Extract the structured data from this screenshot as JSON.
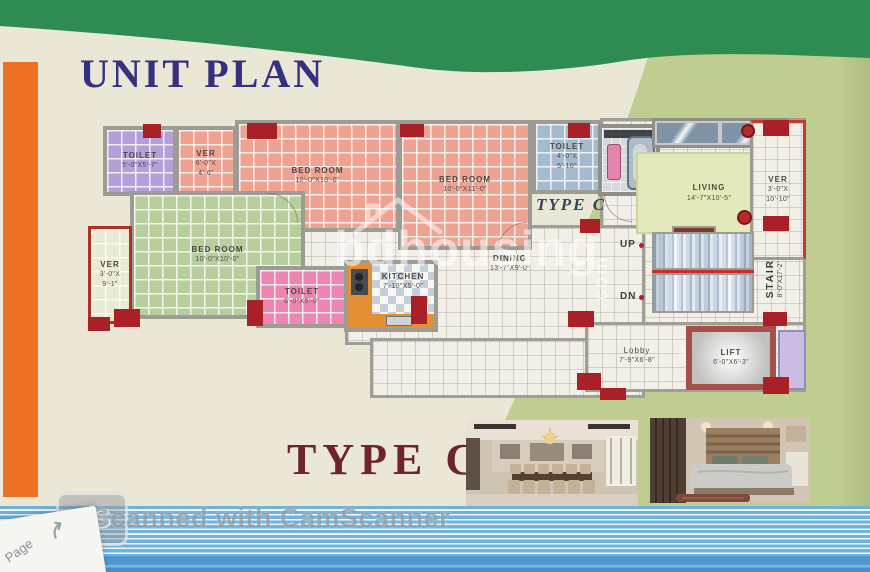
{
  "page": {
    "title": "UNIT PLAN"
  },
  "plan": {
    "inline_type_label": "TYPE C",
    "stair_up": "UP",
    "stair_dn": "DN",
    "rooms": [
      {
        "id": "toilet-top-left",
        "name": "TOILET",
        "dims1": "5'-0\"X5'-7\"",
        "dims2": ""
      },
      {
        "id": "ver-top",
        "name": "VER",
        "dims1": "6'-0\"X",
        "dims2": "4'-6\""
      },
      {
        "id": "bedroom-1",
        "name": "BED ROOM",
        "dims1": "12'-0\"X10'-0\"",
        "dims2": ""
      },
      {
        "id": "bedroom-2",
        "name": "BED ROOM",
        "dims1": "10'-0\"X11'-0\"",
        "dims2": ""
      },
      {
        "id": "toilet-top-right",
        "name": "TOILET",
        "dims1": "4'-0\"X",
        "dims2": "5'-10\""
      },
      {
        "id": "living",
        "name": "LIVING",
        "dims1": "14'-7\"X10'-5\"",
        "dims2": ""
      },
      {
        "id": "ver-right",
        "name": "VER",
        "dims1": "3'-0\"X",
        "dims2": "10'-10\""
      },
      {
        "id": "bedroom-3",
        "name": "BED ROOM",
        "dims1": "10'-0\"X10'-0\"",
        "dims2": ""
      },
      {
        "id": "ver-left",
        "name": "VER",
        "dims1": "3'-0\"X",
        "dims2": "9'-1\""
      },
      {
        "id": "toilet-bottom",
        "name": "TOILET",
        "dims1": "6'-0\"X5'-0\"",
        "dims2": ""
      },
      {
        "id": "kitchen",
        "name": "KITCHEN",
        "dims1": "7'-10\"X5'-0\"",
        "dims2": ""
      },
      {
        "id": "dining",
        "name": "DINING",
        "dims1": "13'-7\"X9'-0\"",
        "dims2": ""
      },
      {
        "id": "stair",
        "name": "STAIR",
        "dims1": "8'-0\"X17'-2\"",
        "dims2": ""
      },
      {
        "id": "lobby",
        "name": "Lobby",
        "dims1": "7'-9\"X6'-8\"",
        "dims2": ""
      },
      {
        "id": "lift",
        "name": "LIFT",
        "dims1": "6'-0\"X6'-3\"",
        "dims2": ""
      }
    ]
  },
  "bottom": {
    "type_title": "TYPE C"
  },
  "watermark": {
    "brand": "bdhousing",
    "tld": ".com"
  },
  "footer": {
    "logo_text": "CS",
    "scan_text": "Scanned with CamScanner",
    "page_tab_label": "Page"
  },
  "colors": {
    "band_green": "#2e8b51",
    "page_cream": "#ebe7d7",
    "accent_orange": "#ee7024",
    "title_navy": "#37307e",
    "type_maroon": "#6d2430",
    "stripe_blue": "#6fb2dc",
    "column_red": "#a92127"
  }
}
